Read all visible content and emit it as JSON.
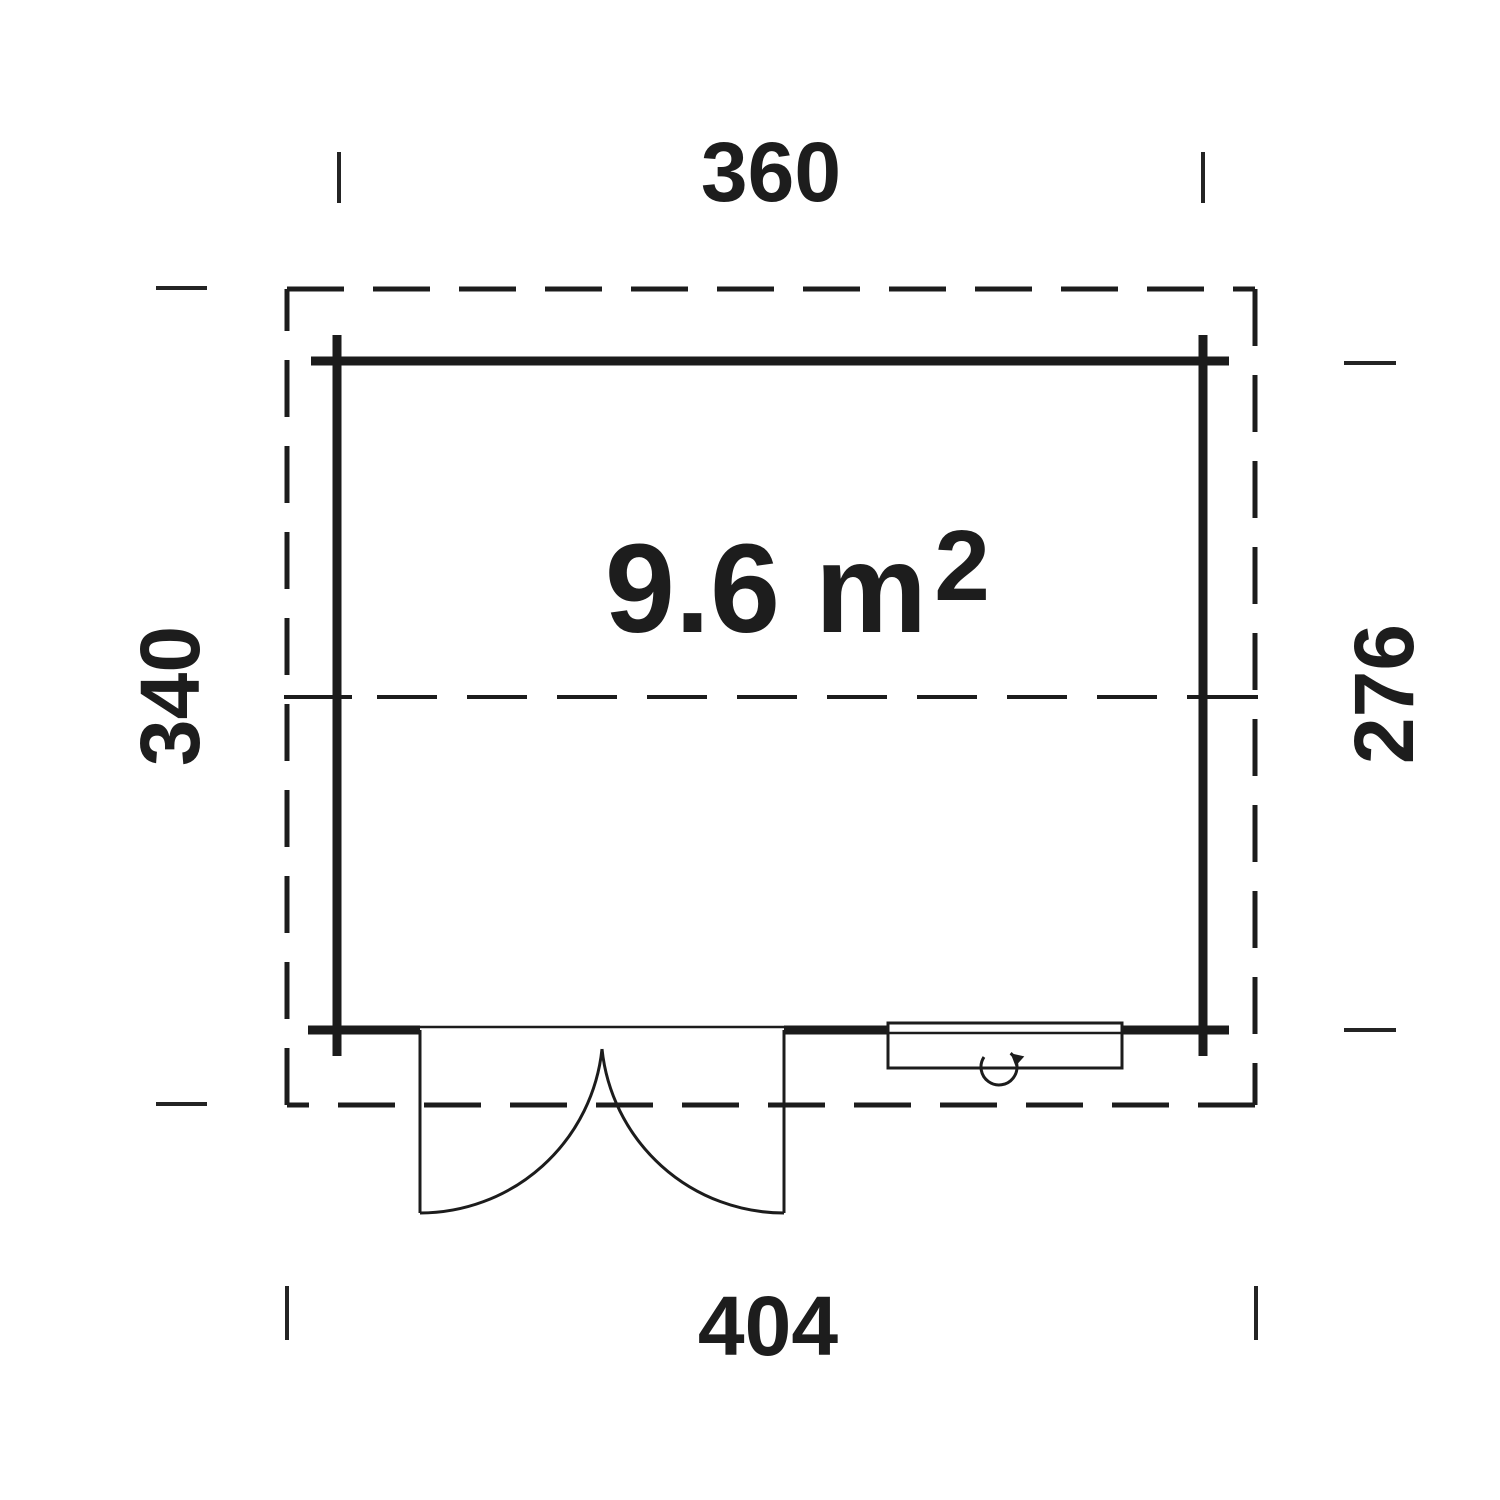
{
  "plan": {
    "type": "floor-plan",
    "area": {
      "value": "9.6 m",
      "superscript": "2"
    },
    "dimensions": {
      "top": "360",
      "left": "340",
      "right": "276",
      "bottom": "404"
    },
    "symbols": {
      "door": "double-outward-swing-door",
      "window": "window-with-rotation-arrow"
    },
    "colors": {
      "ink": "#1c1c1c",
      "background": "#ffffff"
    }
  }
}
